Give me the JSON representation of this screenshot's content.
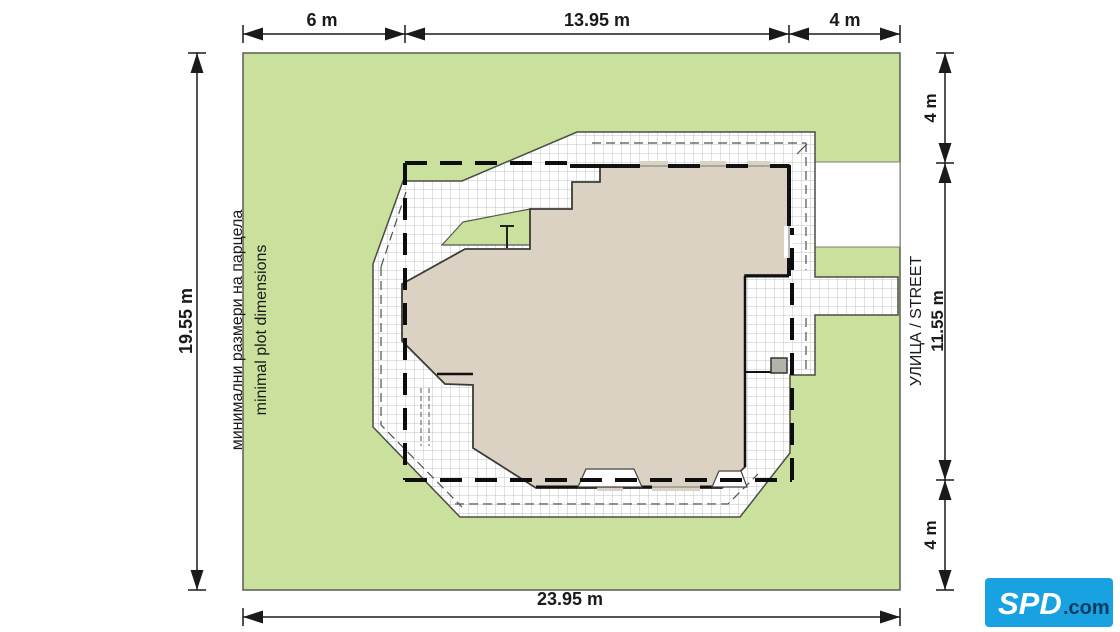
{
  "dims": {
    "top": [
      "6 m",
      "13.95 m",
      "4 m"
    ],
    "left": "19.55 m",
    "right_top": "4 m",
    "street": "УЛИЦА / STREET",
    "right_mid": "11.55 m",
    "right_bottom": "4 m",
    "bottom": "23.95 m"
  },
  "labels": {
    "bg": "минимални размери на парцела",
    "en": "minimal plot dimensions"
  },
  "logo": {
    "name": "SPD",
    "tld": ".com"
  },
  "colors": {
    "plot_green": "#c9e19c",
    "house_fill": "#dbd2c3",
    "terrace_white": "#ffffff",
    "line_black": "#1a1a1a",
    "logo_blue": "#18a2e2"
  }
}
